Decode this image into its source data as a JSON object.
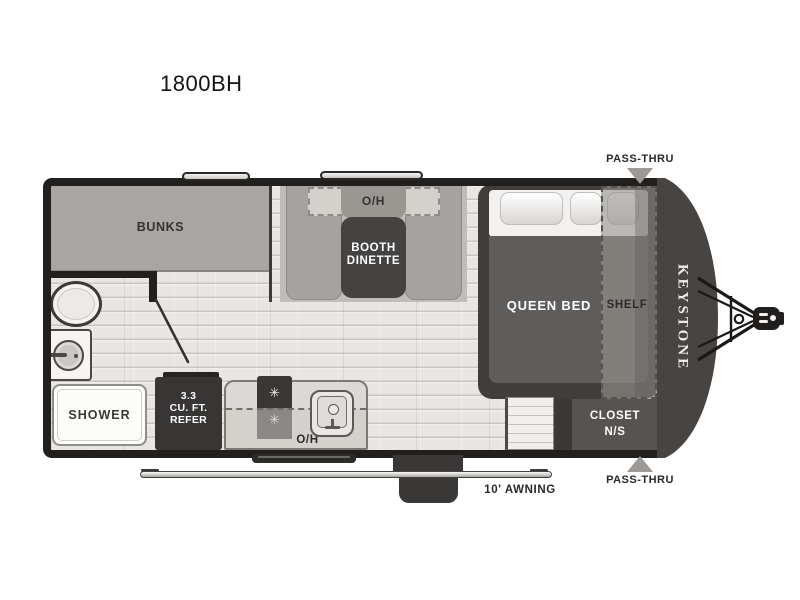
{
  "title": "1800BH",
  "floorplan": {
    "brand_vertical": "KEYSTONE",
    "labels": {
      "bunks": "BUNKS",
      "dinette_overhead": "O/H",
      "dinette_line1": "BOOTH",
      "dinette_line2": "DINETTE",
      "queen_bed": "QUEEN BED",
      "shelf": "SHELF",
      "closet_line1": "CLOSET",
      "closet_line2": "N/S",
      "shower": "SHOWER",
      "refer_line1": "3.3",
      "refer_line2": "CU. FT.",
      "refer_line3": "REFER",
      "kitchen_overhead": "O/H",
      "awning": "10' AWNING",
      "pass_thru_top": "PASS-THRU",
      "pass_thru_bottom": "PASS-THRU"
    },
    "icons": {
      "burner": "✳",
      "pass_thru_arrow_top": "triangle-down",
      "pass_thru_arrow_bottom": "triangle-up"
    },
    "colors": {
      "wall": "#22201f",
      "floor": "#e8e6e4",
      "furniture_gray": "#a8a5a2",
      "table_dark": "#454342",
      "bed_frame": "#403d3c",
      "mattress": "#5f5d5b",
      "nose_cap": "#474441",
      "closet": "#565351",
      "refrigerator": "#383634",
      "counter": "#dbd9d5",
      "pass_thru_arrow": "#9b9896",
      "label_dark": "#2f2d2b",
      "label_light": "#ffffff"
    }
  }
}
